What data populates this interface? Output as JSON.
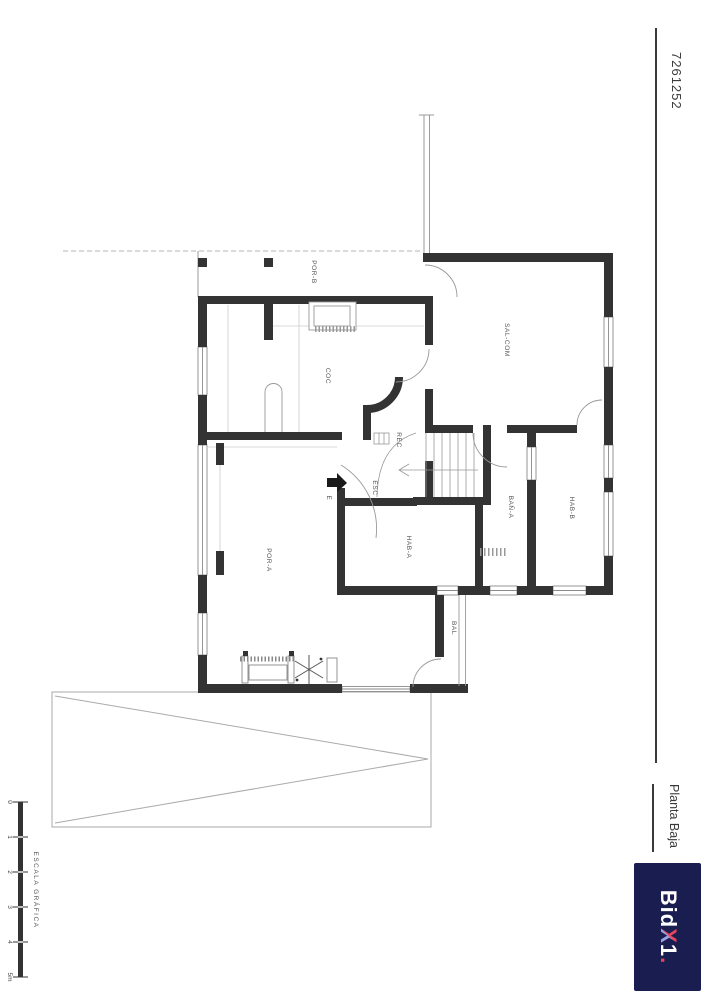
{
  "title_block": {
    "drawing_number": "7261252",
    "plan_title": "Planta Baja",
    "logo_parts": {
      "bid": "Bid",
      "x": "X",
      "one": "1",
      "dot": "."
    },
    "colors": {
      "logo_bg": "#191d4f",
      "logo_red": "#e8455a",
      "logo_periwinkle": "#9aa0e0"
    }
  },
  "scale_bar": {
    "caption": "ESCALA GRÁFICA",
    "ticks": [
      "0",
      "1",
      "2",
      "3",
      "4",
      "5m"
    ]
  },
  "floor_plan": {
    "rooms": [
      {
        "id": "por-b",
        "label": "POR-B"
      },
      {
        "id": "coc",
        "label": "COC"
      },
      {
        "id": "sal-com",
        "label": "SAL-COM"
      },
      {
        "id": "rec",
        "label": "REC"
      },
      {
        "id": "esc",
        "label": "ESC"
      },
      {
        "id": "ban-a",
        "label": "BAÑ-A"
      },
      {
        "id": "hab-a",
        "label": "HAB-A"
      },
      {
        "id": "hab-b",
        "label": "HAB-B"
      },
      {
        "id": "por-a",
        "label": "POR-A"
      },
      {
        "id": "bal",
        "label": "BAL"
      }
    ],
    "entrance_label": "E",
    "colors": {
      "wall": "#333333",
      "thin_line": "#999999",
      "label": "#555555"
    }
  }
}
